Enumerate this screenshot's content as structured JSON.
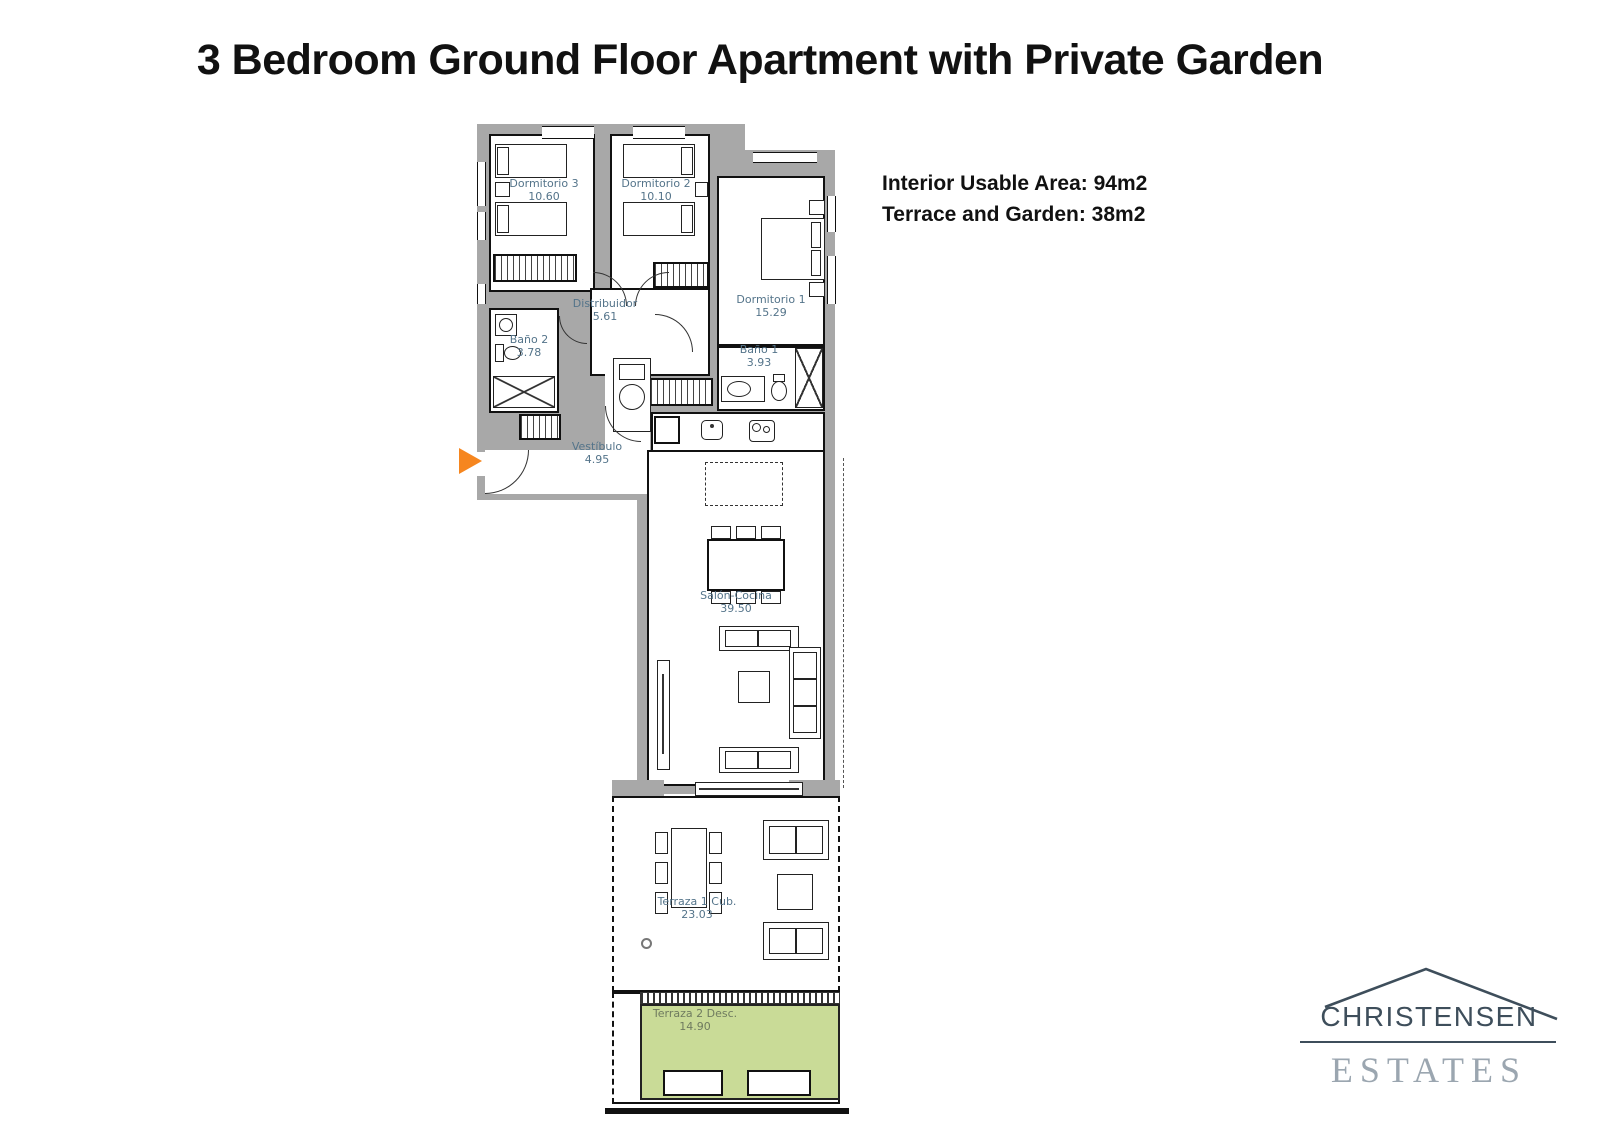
{
  "header": {
    "title": "3 Bedroom Ground Floor Apartment with Private Garden"
  },
  "info": {
    "interior": "Interior Usable Area: 94m2",
    "terrace": "Terrace and Garden: 38m2"
  },
  "plan": {
    "rooms": [
      {
        "name": "Dormitorio 3",
        "area": "10.60"
      },
      {
        "name": "Dormitorio 2",
        "area": "10.10"
      },
      {
        "name": "Dormitorio 1",
        "area": "15.29"
      },
      {
        "name": "Distribuidor",
        "area": "5.61"
      },
      {
        "name": "Baño 2",
        "area": "3.78"
      },
      {
        "name": "Baño 1",
        "area": "3.93"
      },
      {
        "name": "Vestíbulo",
        "area": "4.95"
      },
      {
        "name": "Salón-Cocina",
        "area": "39.50"
      },
      {
        "name": "Terraza 1 Cub.",
        "area": "23.03"
      },
      {
        "name": "Terraza 2 Desc.",
        "area": "14.90"
      }
    ],
    "colors": {
      "wall": "#a8a8a8",
      "label": "#54748a",
      "garden": "#c9db97",
      "arrow": "#f6861f"
    }
  },
  "logo": {
    "name": "CHRISTENSEN",
    "type": "ESTATES",
    "color_dark": "#3e4e5b",
    "color_light": "#9ba6b0"
  }
}
